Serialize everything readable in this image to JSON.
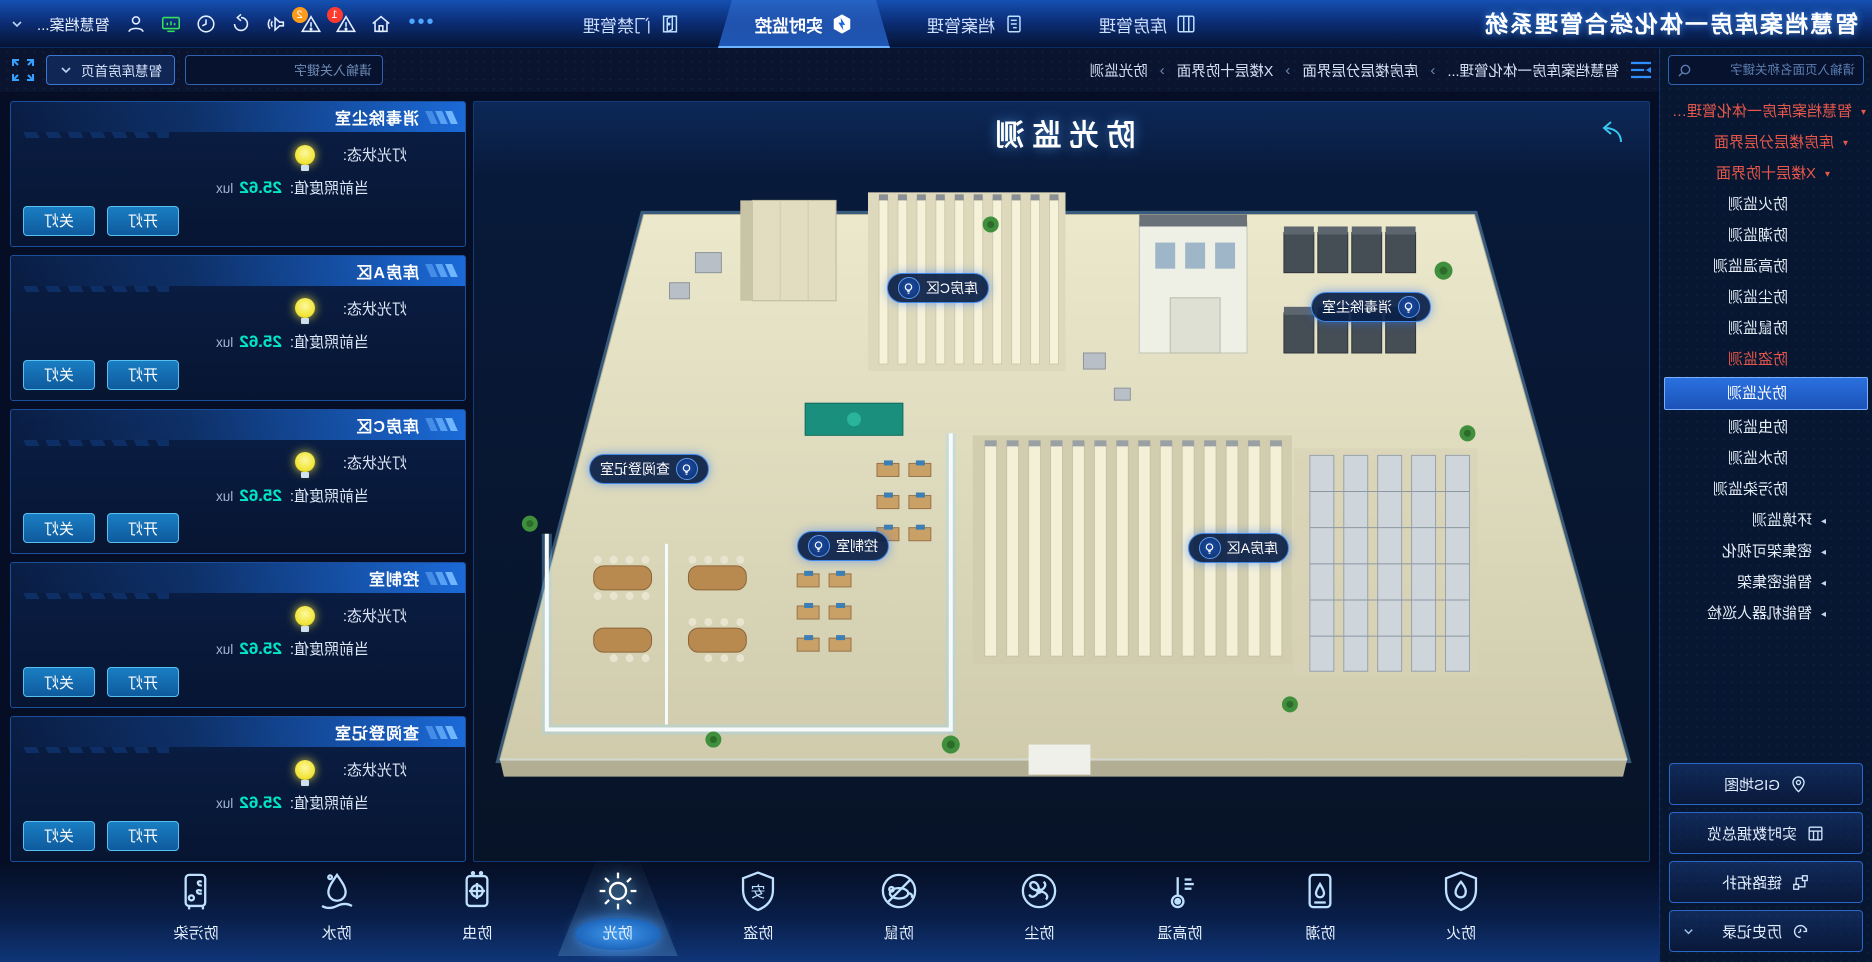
{
  "app_title": "智慧档案库房一体化综合管理系统",
  "topnav": {
    "tabs": [
      {
        "label": "库房管理"
      },
      {
        "label": "档案管理"
      },
      {
        "label": "实时监控"
      },
      {
        "label": "门禁管理"
      }
    ],
    "more_label": "•••",
    "right": {
      "username": "智慧档案...",
      "alarm_badge_1": "1",
      "alarm_badge_2": "2"
    }
  },
  "subbar": {
    "breadcrumb": [
      "智慧档案库房一体化管理...",
      "库房楼层分层界面",
      "X楼层十防界面",
      "防光监测"
    ],
    "separator": "›",
    "keyword_placeholder": "请输入关键字",
    "home_button": "智慧库房首页"
  },
  "sidebar": {
    "search_placeholder": "请输入页面名称关键字",
    "tree": [
      {
        "label": "智慧档案库房一体化管理系...",
        "level": 1,
        "state": "alert",
        "caret": "▾"
      },
      {
        "label": "库房楼层分层界面",
        "level": 2,
        "state": "alert",
        "caret": "▾"
      },
      {
        "label": "X楼层十防界面",
        "level": 3,
        "state": "alert",
        "caret": "▾"
      },
      {
        "label": "防火监测",
        "level": 4,
        "state": "normal"
      },
      {
        "label": "防潮监测",
        "level": 4,
        "state": "normal"
      },
      {
        "label": "防高温监测",
        "level": 4,
        "state": "normal"
      },
      {
        "label": "防尘监测",
        "level": 4,
        "state": "normal"
      },
      {
        "label": "防鼠监测",
        "level": 4,
        "state": "normal"
      },
      {
        "label": "防盗监测",
        "level": 4,
        "state": "alert"
      },
      {
        "label": "防光监测",
        "level": 4,
        "state": "selected"
      },
      {
        "label": "防虫监测",
        "level": 4,
        "state": "normal"
      },
      {
        "label": "防水监测",
        "level": 4,
        "state": "normal"
      },
      {
        "label": "防污染监测",
        "level": 4,
        "state": "normal"
      },
      {
        "label": "环境监测",
        "level": 2,
        "state": "normal",
        "caret": "▸"
      },
      {
        "label": "密集架可视化",
        "level": 2,
        "state": "normal",
        "caret": "▸"
      },
      {
        "label": "智能密集架",
        "level": 2,
        "state": "normal",
        "caret": "▸"
      },
      {
        "label": "智能机器人巡检",
        "level": 2,
        "state": "normal",
        "caret": "▸"
      }
    ],
    "buttons": [
      {
        "label": "GIS地图"
      },
      {
        "label": "实时数据总览"
      },
      {
        "label": "链路拓扑"
      },
      {
        "label": "历史记录"
      }
    ]
  },
  "map": {
    "title": "防光监测",
    "labels": [
      {
        "name": "库房C区"
      },
      {
        "name": "消毒除尘室"
      },
      {
        "name": "查阅登记室"
      },
      {
        "name": "控制室"
      },
      {
        "name": "库房A区"
      }
    ]
  },
  "cards": {
    "fields": {
      "light_label": "灯光状态:",
      "lux_label": "当前照度值:",
      "lux_value": "25.62",
      "lux_unit": "lux",
      "on_button": "开灯",
      "off_button": "关灯"
    },
    "items": [
      {
        "title": "消毒除尘室"
      },
      {
        "title": "库房A区"
      },
      {
        "title": "库房C区"
      },
      {
        "title": "控制室"
      },
      {
        "title": "查阅登记室"
      }
    ]
  },
  "bottombar": [
    {
      "label": "防火"
    },
    {
      "label": "防潮"
    },
    {
      "label": "防高温"
    },
    {
      "label": "防尘"
    },
    {
      "label": "防鼠"
    },
    {
      "label": "防盗"
    },
    {
      "label": "防光",
      "active": true
    },
    {
      "label": "防虫"
    },
    {
      "label": "防水"
    },
    {
      "label": "防污染"
    }
  ],
  "colors": {
    "accent": "#2e7de8",
    "alert": "#e8584a",
    "selected_bg": "#1f64d8",
    "cyan_value": "#00e6c8",
    "bulb_yellow": "#f2e63c",
    "tab_text": "#cfe0ff"
  }
}
